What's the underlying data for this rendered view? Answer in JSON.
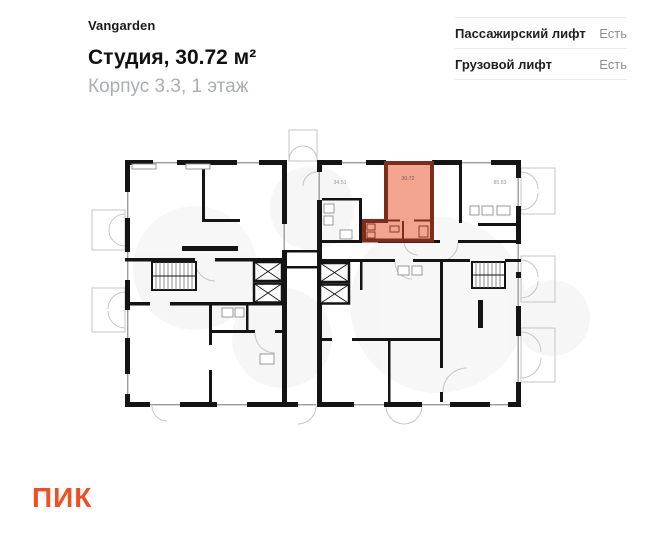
{
  "header": {
    "brand": "Vangarden",
    "title": "Студия, 30.72 м²",
    "subtitle": "Корпус 3.3, 1 этаж"
  },
  "amenities": {
    "rows": [
      {
        "label": "Пассажирский лифт",
        "value": "Есть"
      },
      {
        "label": "Грузовой лифт",
        "value": "Есть"
      }
    ]
  },
  "plan": {
    "units": [
      {
        "name": "apartment-left",
        "area": "34.51"
      },
      {
        "name": "studio-highlighted",
        "area": "30.72"
      },
      {
        "name": "apartment-right",
        "area": "85.83"
      }
    ],
    "highlight": {
      "fill": "#F2A48F",
      "wall": "#7E2D1C"
    },
    "wall_color": "#141414"
  },
  "footer": {
    "logo": "ПИК",
    "logo_color": "#F04E23"
  }
}
